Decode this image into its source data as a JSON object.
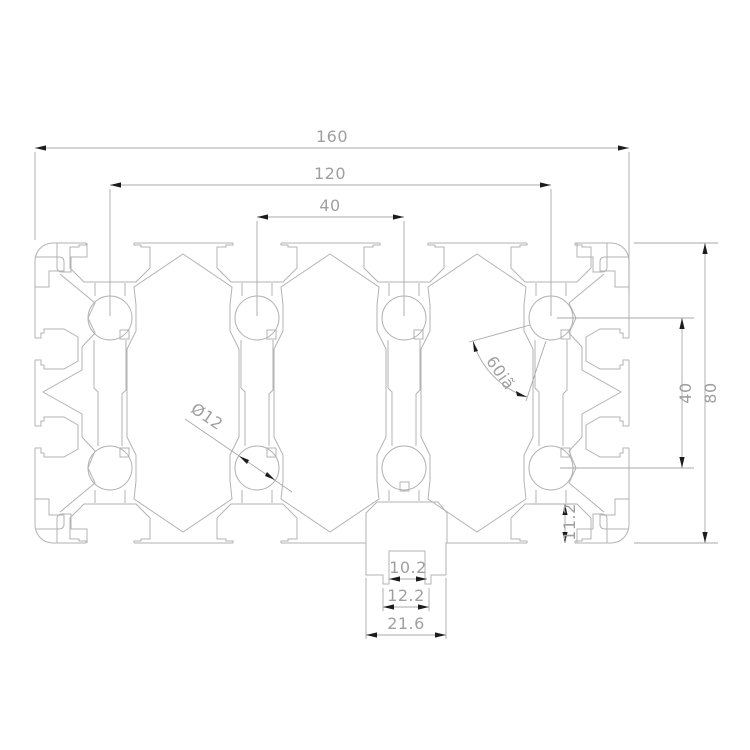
{
  "drawing": {
    "type": "technical-drawing-profile-cross-section",
    "dimensions": {
      "overall_width": "160",
      "hole_span": "120",
      "hole_pitch": "40",
      "overall_height": "80",
      "hole_row_span": "40",
      "slot_depth": "11.2",
      "channel_inner_width": "10.2",
      "channel_wall_width": "12.2",
      "channel_outer_width": "21.6",
      "hole_diameter": "Ø12",
      "slot_angle": "60iã"
    },
    "colors": {
      "background": "#ffffff",
      "profile_line": "#b3b3b3",
      "dimension_line": "#a9a9a9",
      "dimension_text": "#9f9f9f",
      "arrow": "#1c1c1c"
    }
  }
}
